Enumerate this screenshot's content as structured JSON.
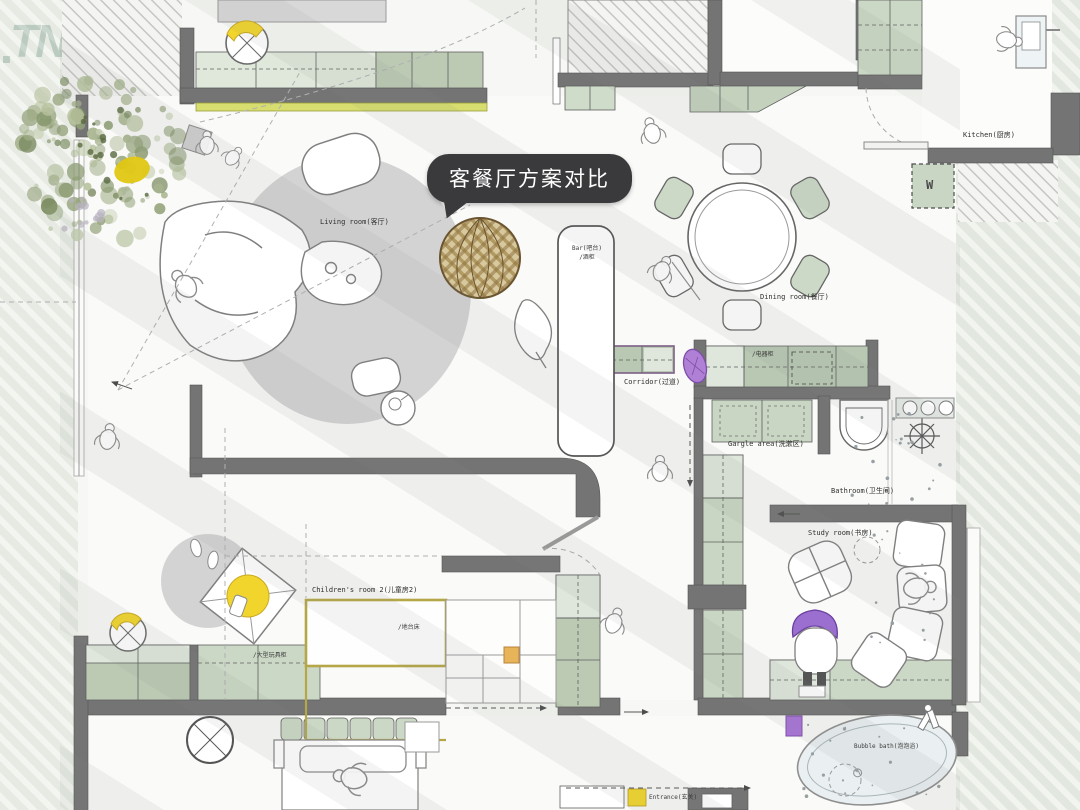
{
  "logo": {
    "text": "TN"
  },
  "callout": {
    "text": "客餐厅方案对比"
  },
  "labels": {
    "living_room": "Living room(客厅)",
    "dining_room": "Dining room(餐厅)",
    "kitchen": "Kitchen(厨房)",
    "bar_line1": "Bar(吧台)",
    "bar_line2": "/酒柜",
    "corridor": "Corridor(过道)",
    "appliance_cabinet": "/电器柜",
    "gargle_area": "Gargle area(洗漱区)",
    "bathroom": "Bathroom(卫生间)",
    "study_room": "Study room(书房)",
    "children_room2": "Children's room 2(儿童房2)",
    "platform_bed": "/地台床",
    "toy_cabinet": "/大型玩具柜",
    "bubble_bath": "Bubble bath(泡泡浴)",
    "entrance": "Entrance(玄关)",
    "washer": "W"
  },
  "colors": {
    "wall": "#747474",
    "cabinet_sage": "#bccab4",
    "cabinet_light": "#e0e8dc",
    "accent_yellowgreen": "#d7dd6e",
    "accent_yellow": "#f2d52c",
    "accent_purple": "#a873d6",
    "bed_frame_yellow": "#b5a648",
    "callout_bg": "#3a3a3c",
    "logo_green": "#1f5c45",
    "rug_gray": "#d2d2d2"
  }
}
